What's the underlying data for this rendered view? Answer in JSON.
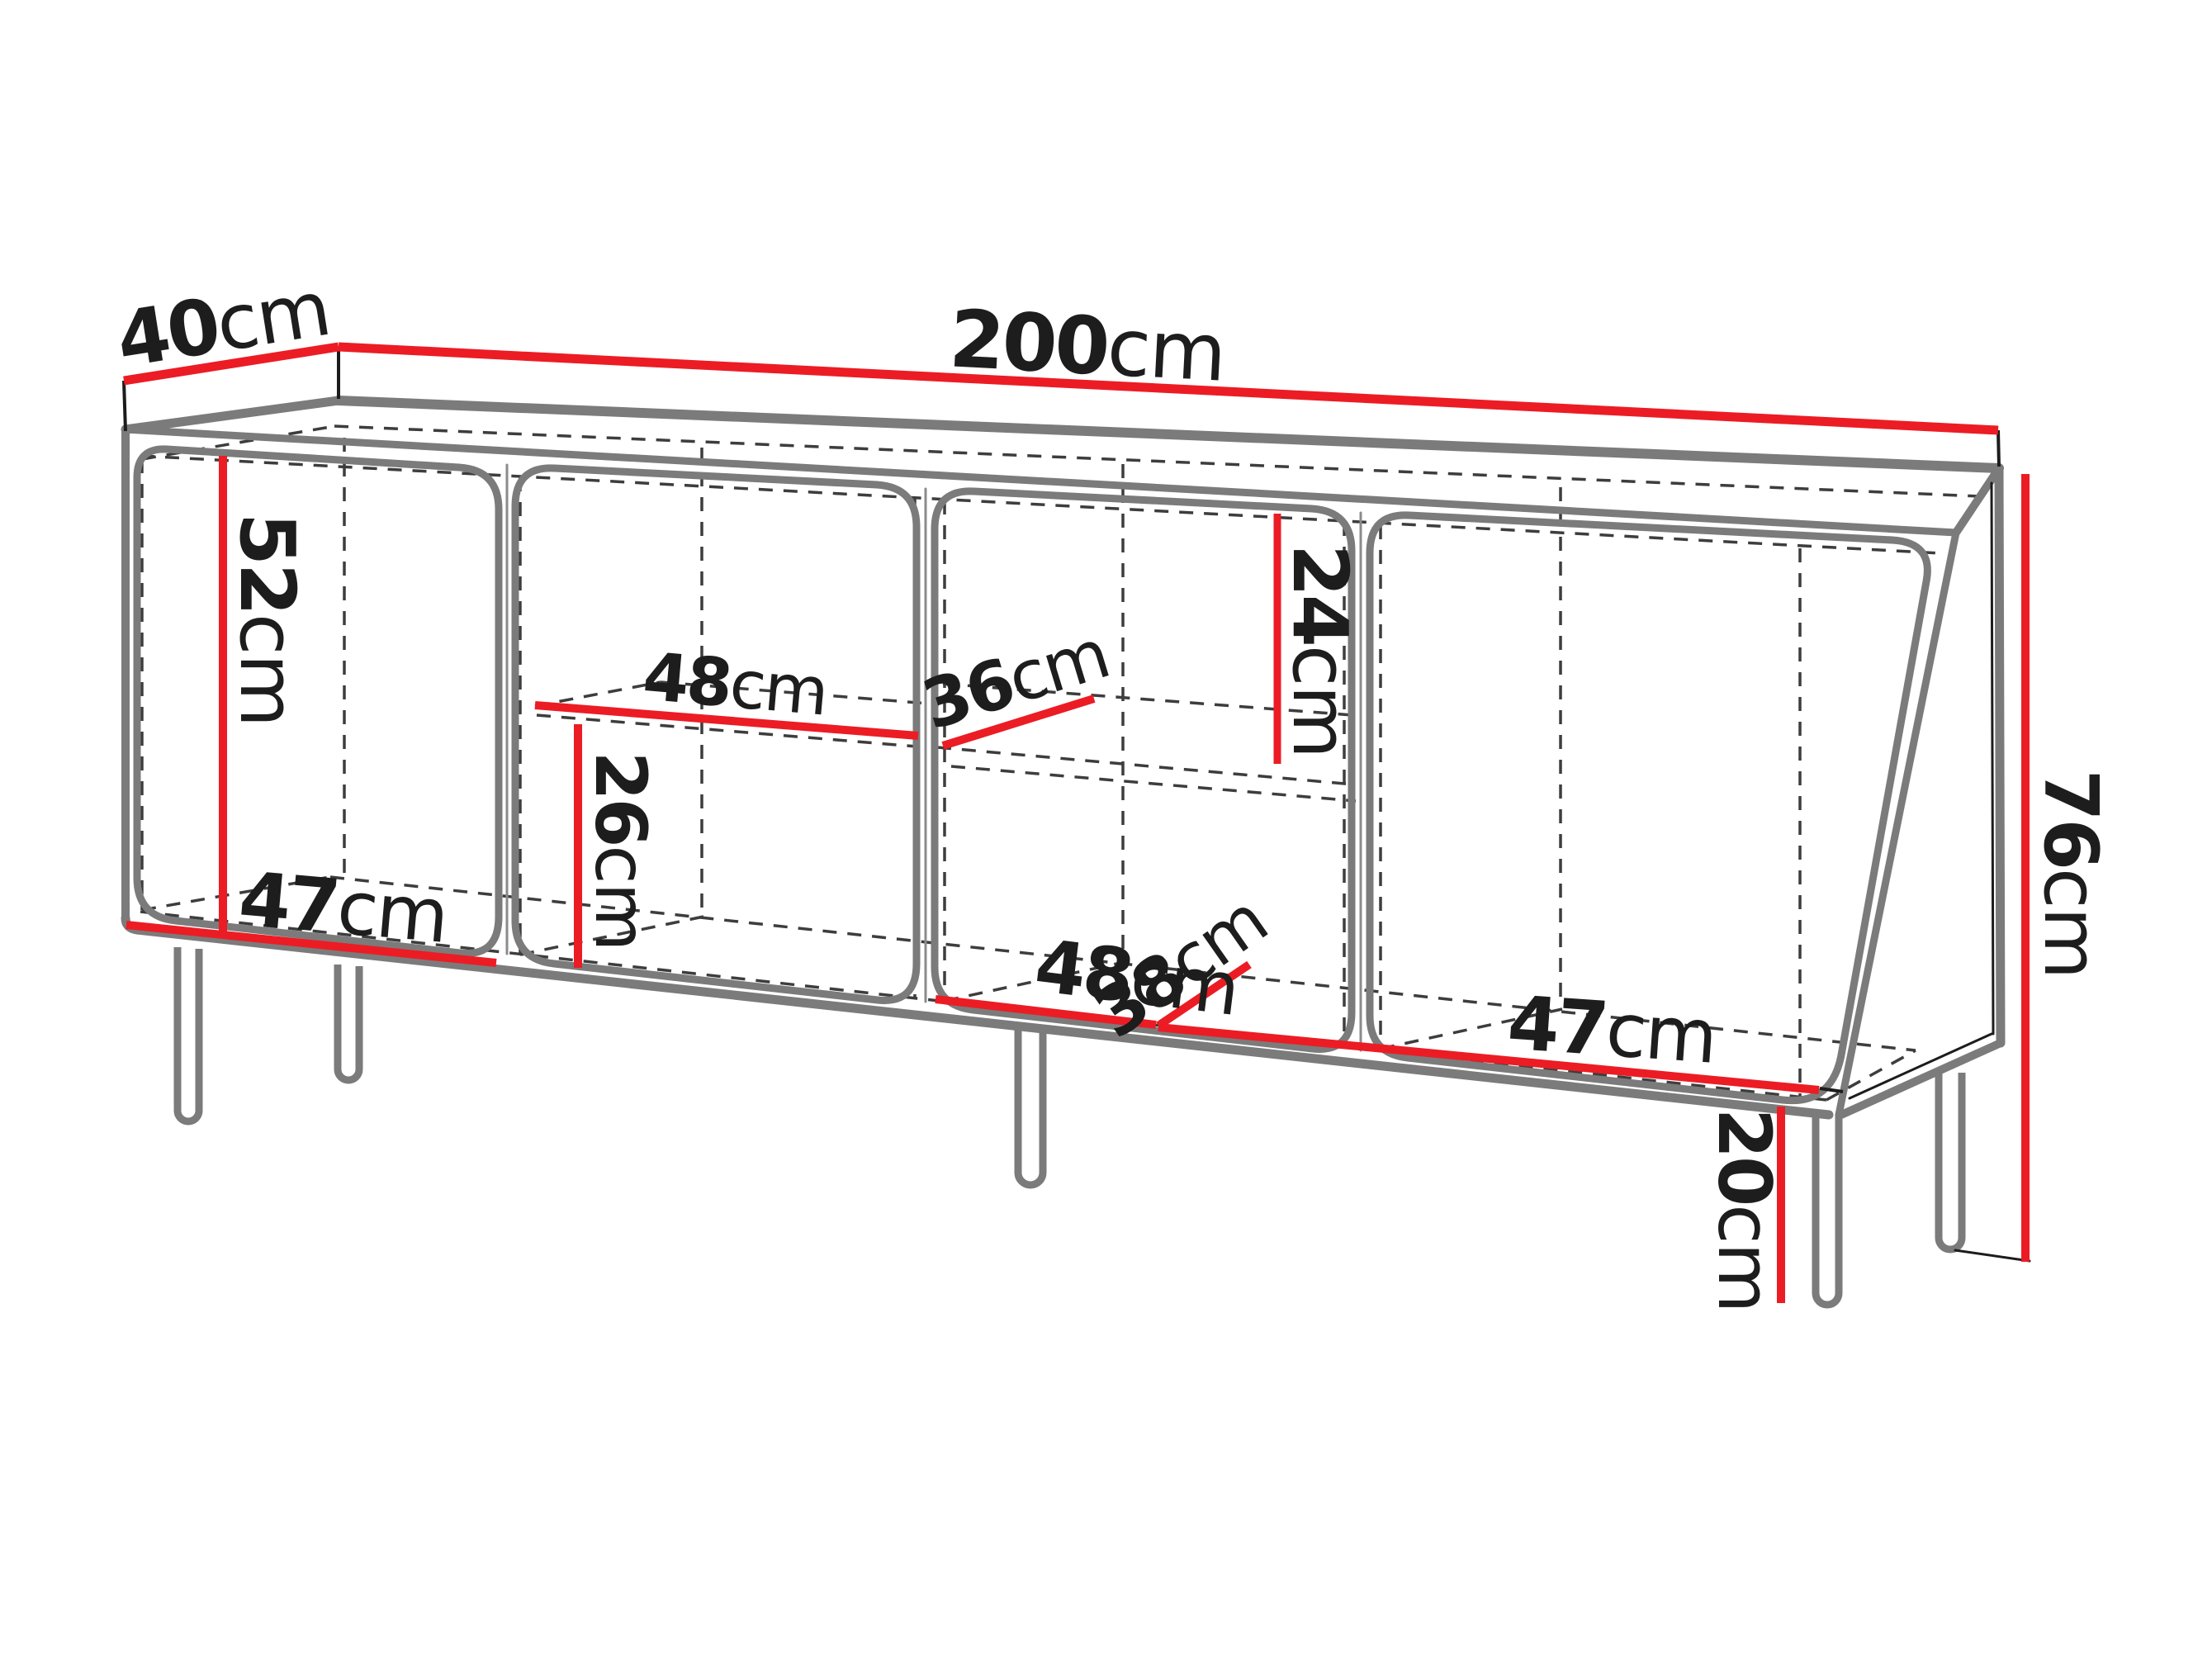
{
  "diagram": {
    "title": "sideboard-dimension-drawing",
    "unit": "cm",
    "colors": {
      "dimension": "#ec1c24",
      "outline": "#7b7b7b",
      "detail": "#1c1c1c",
      "hidden": "#3d3d3d",
      "label": "#1d1d1d",
      "background": "#ffffff"
    },
    "dimensions": {
      "depth": {
        "value": "40",
        "unit": "cm"
      },
      "width": {
        "value": "200",
        "unit": "cm"
      },
      "total_height": {
        "value": "76",
        "unit": "cm"
      },
      "leg_height": {
        "value": "20",
        "unit": "cm"
      },
      "left_interior_height": {
        "value": "52",
        "unit": "cm"
      },
      "left_interior_width": {
        "value": "47",
        "unit": "cm"
      },
      "shelf_width": {
        "value": "48",
        "unit": "cm"
      },
      "shelf_depth": {
        "value": "36",
        "unit": "cm"
      },
      "above_shelf_height": {
        "value": "24",
        "unit": "cm"
      },
      "below_shelf_height": {
        "value": "26",
        "unit": "cm"
      },
      "bottom_interior_width": {
        "value": "48",
        "unit": "cm"
      },
      "bottom_interior_depth": {
        "value": "38",
        "unit": "cm"
      },
      "right_interior_width": {
        "value": "47",
        "unit": "cm"
      }
    }
  }
}
